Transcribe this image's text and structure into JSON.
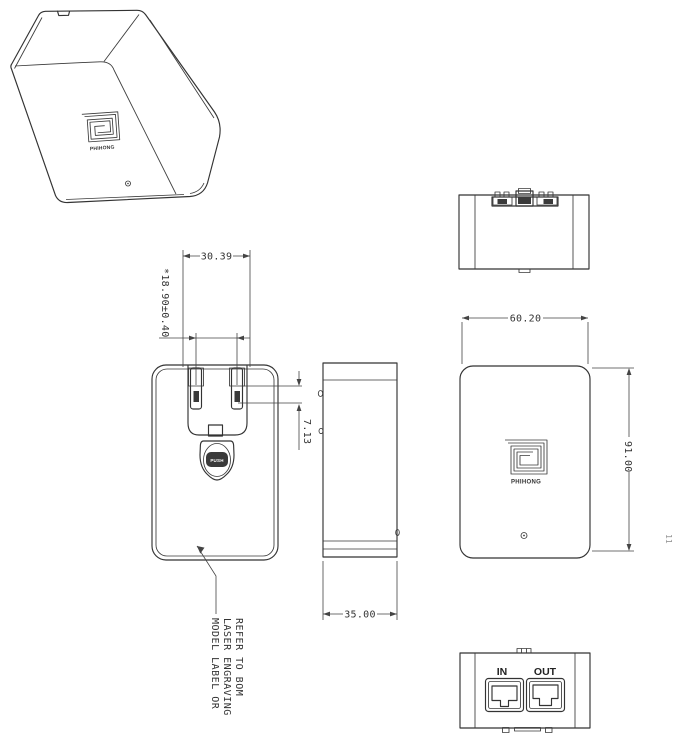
{
  "canvas": {
    "background": "#ffffff",
    "line_color": "#333333",
    "dim_color": "#444444"
  },
  "views": {
    "isometric": {
      "logo_text": "PHIHONG"
    },
    "front": {
      "dim_prong_width": "30.39",
      "dim_blade_span": "*18.90±0.40",
      "dim_blade_offset": "7.13",
      "push_label": "PUSH",
      "note_line1": "MODEL LABEL OR",
      "note_line2": "LASER ENGRAVING",
      "note_line3": "REFER TO BOM"
    },
    "side": {
      "dim_depth": "35.00"
    },
    "back": {
      "dim_width": "60.20",
      "dim_height": "91.00",
      "logo_text": "PHIHONG"
    },
    "bottom": {
      "port_in_label": "IN",
      "port_out_label": "OUT"
    },
    "margin_mark": "11"
  }
}
